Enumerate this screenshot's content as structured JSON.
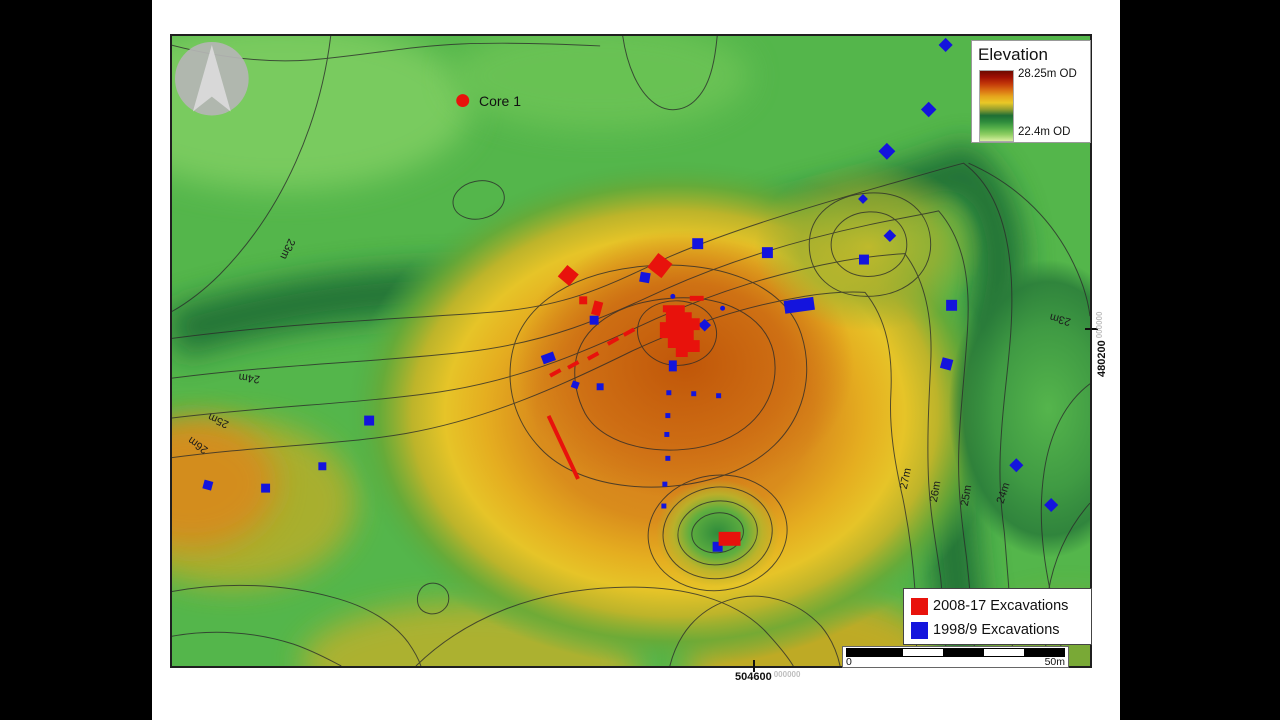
{
  "colors": {
    "red_marker": "#e8120c",
    "blue_marker": "#1414dd",
    "contour_line": "#2a2a2a",
    "base_green": "#54b64b"
  },
  "core_marker": {
    "label": "Core 1"
  },
  "elevation_legend": {
    "title": "Elevation",
    "max_label": "28.25m OD",
    "min_label": "22.4m OD",
    "gradient": [
      "#6f0a00",
      "#a01104",
      "#c23709",
      "#d96d12",
      "#e6a51c",
      "#e9c827",
      "#97a02d",
      "#1d6e34",
      "#2f8c3c",
      "#58b14a",
      "#90cf63",
      "#d8efa0"
    ]
  },
  "excavation_legend": {
    "items": [
      {
        "label": "2008-17 Excavations",
        "color": "#e8120c"
      },
      {
        "label": "1998/9 Excavations",
        "color": "#1414dd"
      }
    ]
  },
  "scale_bar": {
    "start_label": "0",
    "end_label": "50m",
    "segments": [
      "#000000",
      "#ffffff",
      "#000000",
      "#ffffff",
      "#000000"
    ]
  },
  "grid_coordinates": {
    "right": {
      "value": "480200",
      "suffix": "000000"
    },
    "bottom": {
      "value": "504600",
      "suffix": "000000"
    }
  },
  "contour_labels": [
    {
      "text": "23m",
      "x": 113,
      "y": 213,
      "rot": 115
    },
    {
      "text": "24m",
      "x": 78,
      "y": 341,
      "rot": 187
    },
    {
      "text": "25m",
      "x": 48,
      "y": 384,
      "rot": 205
    },
    {
      "text": "26m",
      "x": 28,
      "y": 409,
      "rot": 215
    },
    {
      "text": "27m",
      "x": 740,
      "y": 446,
      "rot": -78
    },
    {
      "text": "26m",
      "x": 770,
      "y": 459,
      "rot": -80
    },
    {
      "text": "25m",
      "x": 801,
      "y": 463,
      "rot": -80
    },
    {
      "text": "24m",
      "x": 838,
      "y": 461,
      "rot": -72
    },
    {
      "text": "23m",
      "x": 893,
      "y": 282,
      "rot": 195
    }
  ],
  "markers": {
    "red": [
      {
        "shape": "dot",
        "x": 292,
        "y": 65,
        "r": 6.5
      },
      {
        "shape": "sq",
        "x": 398,
        "y": 241,
        "s": 15,
        "rot": 40
      },
      {
        "shape": "sq",
        "x": 490,
        "y": 231,
        "s": 18,
        "rot": 38
      },
      {
        "shape": "sq",
        "x": 413,
        "y": 266,
        "s": 8
      },
      {
        "shape": "rect",
        "x": 427,
        "y": 274,
        "w": 9,
        "h": 14,
        "rot": 15
      },
      {
        "shape": "rect",
        "x": 527,
        "y": 264,
        "w": 14,
        "h": 5
      },
      {
        "shape": "poly",
        "points": "493,271 515,271 515,278 522,278 522,284 530,284 530,296 524,296 524,306 530,306 530,318 518,318 518,323 506,323 506,314 498,314 498,304 490,304 490,288 496,288 496,278 493,278"
      },
      {
        "shape": "rect",
        "x": 385,
        "y": 339,
        "w": 12,
        "h": 4,
        "rot": -29
      },
      {
        "shape": "rect",
        "x": 403,
        "y": 331,
        "w": 12,
        "h": 4,
        "rot": -29
      },
      {
        "shape": "rect",
        "x": 423,
        "y": 322,
        "w": 12,
        "h": 4,
        "rot": -29
      },
      {
        "shape": "rect",
        "x": 443,
        "y": 307,
        "w": 12,
        "h": 4,
        "rot": -29
      },
      {
        "shape": "rect",
        "x": 459,
        "y": 298,
        "w": 12,
        "h": 4,
        "rot": -29
      },
      {
        "shape": "rect",
        "x": 393,
        "y": 414,
        "w": 4,
        "h": 70,
        "rot": -25
      },
      {
        "shape": "rect",
        "x": 560,
        "y": 506,
        "w": 22,
        "h": 14
      }
    ],
    "blue": [
      {
        "shape": "rect",
        "x": 378,
        "y": 324,
        "w": 13,
        "h": 9,
        "rot": -20
      },
      {
        "shape": "sq",
        "x": 424,
        "y": 286,
        "s": 9
      },
      {
        "shape": "sq",
        "x": 475,
        "y": 243,
        "s": 10,
        "rot": 10
      },
      {
        "shape": "sq",
        "x": 528,
        "y": 209,
        "s": 11
      },
      {
        "shape": "sq",
        "x": 598,
        "y": 218,
        "s": 11
      },
      {
        "shape": "rect",
        "x": 630,
        "y": 271,
        "w": 30,
        "h": 13,
        "rot": -8
      },
      {
        "shape": "sq",
        "x": 695,
        "y": 225,
        "s": 10
      },
      {
        "shape": "dia",
        "x": 721,
        "y": 201,
        "s": 9
      },
      {
        "shape": "dia",
        "x": 760,
        "y": 74,
        "s": 11
      },
      {
        "shape": "dia",
        "x": 718,
        "y": 116,
        "s": 12
      },
      {
        "shape": "dia",
        "x": 694,
        "y": 164,
        "s": 7
      },
      {
        "shape": "dia",
        "x": 777,
        "y": 9,
        "s": 10
      },
      {
        "shape": "sq",
        "x": 783,
        "y": 271,
        "s": 11
      },
      {
        "shape": "sq",
        "x": 778,
        "y": 330,
        "s": 11,
        "rot": 15
      },
      {
        "shape": "dia",
        "x": 848,
        "y": 432,
        "s": 10
      },
      {
        "shape": "dia",
        "x": 883,
        "y": 472,
        "s": 10
      },
      {
        "shape": "rect",
        "x": 503,
        "y": 332,
        "w": 8,
        "h": 11
      },
      {
        "shape": "dot",
        "x": 503,
        "y": 262,
        "r": 2.5
      },
      {
        "shape": "dot",
        "x": 553,
        "y": 274,
        "r": 2.5
      },
      {
        "shape": "dia",
        "x": 535,
        "y": 291,
        "s": 9
      },
      {
        "shape": "sq",
        "x": 405,
        "y": 351,
        "s": 7,
        "rot": 20
      },
      {
        "shape": "sq",
        "x": 430,
        "y": 353,
        "s": 7
      },
      {
        "shape": "sq",
        "x": 499,
        "y": 359,
        "s": 5
      },
      {
        "shape": "sq",
        "x": 524,
        "y": 360,
        "s": 5
      },
      {
        "shape": "sq",
        "x": 549,
        "y": 362,
        "s": 5
      },
      {
        "shape": "sq",
        "x": 498,
        "y": 382,
        "s": 5
      },
      {
        "shape": "sq",
        "x": 497,
        "y": 401,
        "s": 5
      },
      {
        "shape": "sq",
        "x": 498,
        "y": 425,
        "s": 5
      },
      {
        "shape": "sq",
        "x": 495,
        "y": 451,
        "s": 5
      },
      {
        "shape": "sq",
        "x": 494,
        "y": 473,
        "s": 5
      },
      {
        "shape": "sq",
        "x": 548,
        "y": 514,
        "s": 10
      },
      {
        "shape": "sq",
        "x": 198,
        "y": 387,
        "s": 10
      },
      {
        "shape": "sq",
        "x": 151,
        "y": 433,
        "s": 8
      },
      {
        "shape": "sq",
        "x": 94,
        "y": 455,
        "s": 9
      },
      {
        "shape": "sq",
        "x": 36,
        "y": 452,
        "s": 9,
        "rot": 15
      }
    ]
  }
}
